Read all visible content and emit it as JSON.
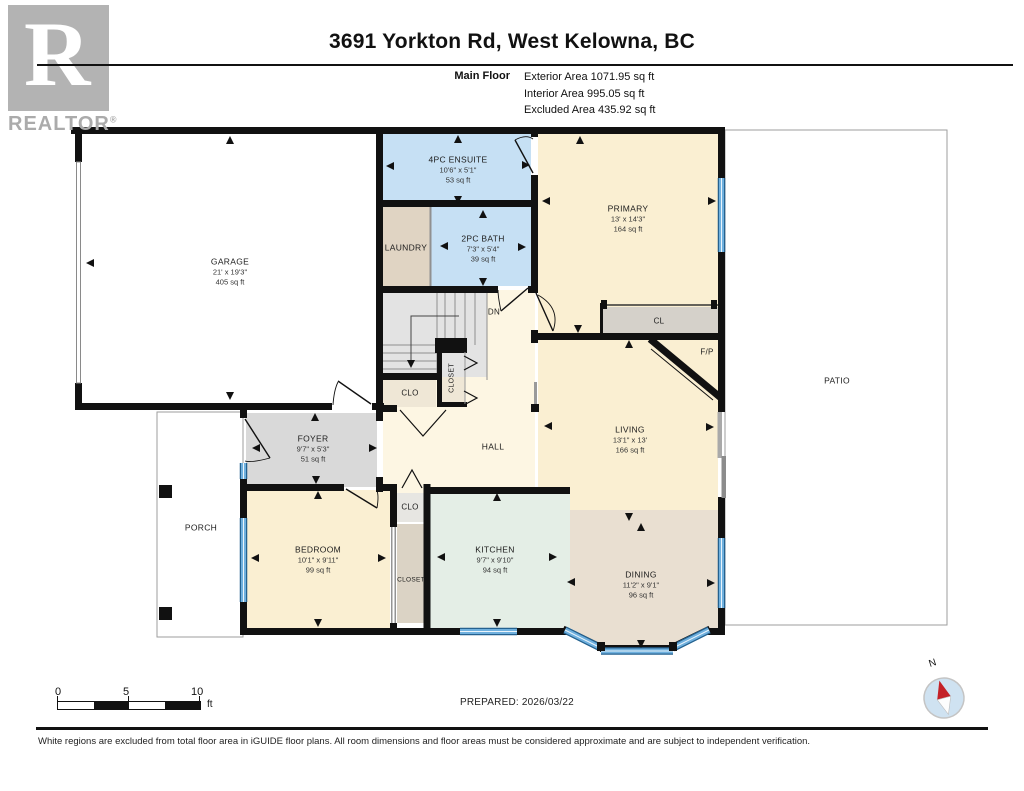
{
  "header": {
    "title": "3691 Yorkton Rd, West Kelowna, BC",
    "floor_label": "Main Floor",
    "area_lines": [
      "Exterior Area 1071.95 sq ft",
      "Interior Area 995.05 sq ft",
      "Excluded Area 435.92 sq ft"
    ]
  },
  "branding": {
    "realtor_logo_letter": "R",
    "realtor_text": "REALTOR",
    "registered_mark": "®"
  },
  "rooms": [
    {
      "name": "GARAGE",
      "dims": "21' x 19'3\"",
      "area": "405 sq ft"
    },
    {
      "name": "4PC ENSUITE",
      "dims": "10'6\" x 5'1\"",
      "area": "53 sq ft"
    },
    {
      "name": "PRIMARY",
      "dims": "13' x 14'3\"",
      "area": "164 sq ft"
    },
    {
      "name": "LAUNDRY"
    },
    {
      "name": "2PC BATH",
      "dims": "7'3\" x 5'4\"",
      "area": "39 sq ft"
    },
    {
      "name": "LIVING",
      "dims": "13'1\" x 13'",
      "area": "166 sq ft"
    },
    {
      "name": "FOYER",
      "dims": "9'7\" x 5'3\"",
      "area": "51 sq ft"
    },
    {
      "name": "BEDROOM",
      "dims": "10'1\" x 9'11\"",
      "area": "99 sq ft"
    },
    {
      "name": "KITCHEN",
      "dims": "9'7\" x 9'10\"",
      "area": "94 sq ft"
    },
    {
      "name": "DINING",
      "dims": "11'2\" x 9'1\"",
      "area": "96 sq ft"
    },
    {
      "name": "HALL"
    },
    {
      "name": "PORCH"
    },
    {
      "name": "PATIO"
    }
  ],
  "labels": {
    "cl": "CL",
    "fp": "F/P",
    "dn": "DN",
    "hall_clo": "CLO",
    "hall_closet": "CLOSET",
    "bedroom_clo": "CLO",
    "bedroom_closet": "CLOSET"
  },
  "scale_bar": {
    "tick0": "0",
    "tick5": "5",
    "tick10": "10",
    "unit": "ft"
  },
  "prepared_text": "PREPARED: 2026/03/22",
  "compass": {
    "north": "N"
  },
  "footer": {
    "disclaimer": "White regions are excluded from total floor area in iGUIDE floor plans. All room dimensions and floor areas must be considered approximate and are subject to independent verification."
  },
  "colors": {
    "wall": "#111111",
    "window_blue": "#6fb0de",
    "window_edge": "#24618f",
    "window_stripe": "#eaf4fb",
    "bath_blue": "#c6e0f4",
    "room_cream": "#faefd2",
    "hall_cream": "#fdf6e3",
    "laundry_tan": "#e0d4c3",
    "foyer_gray": "#d9d9d9",
    "kitchen_green": "#e4eee6",
    "dining_tan": "#e9dfd1",
    "closet_gray": "#d5d1ca",
    "closet_cream": "#efe7d6",
    "closet_tan": "#dbd3c5",
    "clo_gray": "#e7e6e2",
    "stairs_gray": "#e3e3e3",
    "compass_red": "#c42127"
  }
}
